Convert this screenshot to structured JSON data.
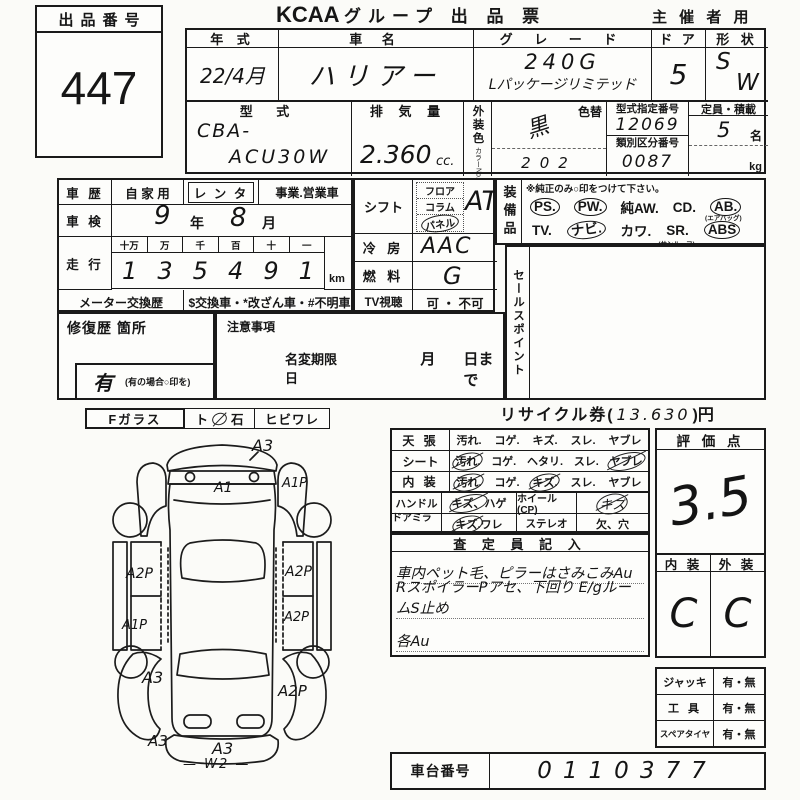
{
  "auction": {
    "label": "出品番号",
    "number": "447"
  },
  "header": {
    "brand": "KCAA",
    "title": "グループ 出 品 票",
    "organizer": "主 催 者 用"
  },
  "vehicle": {
    "year": {
      "label": "年 式",
      "value": "22/4月"
    },
    "name": {
      "label": "車 名",
      "value": "ハリアー"
    },
    "grade": {
      "label": "グ レ ー ド",
      "line1": "240G",
      "line2": "Lパッケージリミテッド"
    },
    "door": {
      "label": "ド ア",
      "value": "5"
    },
    "shape": {
      "label": "形 状",
      "v1": "S",
      "v2": "W"
    },
    "model": {
      "label": "型 式",
      "line1": "CBA-",
      "line2": "ACU30W"
    },
    "displacement": {
      "label": "排 気 量",
      "value": "2.360",
      "unit": "cc."
    },
    "ext_color": {
      "label": "外装色",
      "no_label": "カラーNo.",
      "change_label": "色替",
      "value": "黒",
      "code": "202"
    },
    "type_cert": {
      "label": "型式指定番号",
      "value": "12069"
    },
    "class_no": {
      "label": "類別区分番号",
      "value": "0087"
    },
    "capacity": {
      "label": "定員・積載",
      "value": "5",
      "unit": "名",
      "load_unit": "kg"
    }
  },
  "history": {
    "car_use": {
      "label": "車 歴",
      "opt1": "自 家 用",
      "opt2": "レ ン タ",
      "opt3": "事業.営業車"
    },
    "inspection": {
      "label": "車 検",
      "year": "9",
      "year_unit": "年",
      "month": "8",
      "month_unit": "月"
    },
    "mileage": {
      "label": "走 行",
      "units": [
        "十万",
        "万",
        "千",
        "百",
        "十",
        "一"
      ],
      "digits": [
        "1",
        "3",
        "5",
        "4",
        "9",
        "1"
      ],
      "km": "km"
    },
    "meter": {
      "label": "メーター交換歴",
      "text": "$交換車・*改ざん車・#不明車"
    },
    "repair": {
      "label": "修復歴  箇所",
      "yes": "有",
      "note": "(有の場合○印を)"
    },
    "caution": {
      "label": "注意事項"
    },
    "name_change": {
      "label": "名変期限日",
      "month": "月",
      "day": "日まで"
    }
  },
  "specs": {
    "shift": {
      "label": "シフト",
      "opt1": "フロア",
      "opt2": "コラム",
      "opt3": "パネル",
      "value": "AT."
    },
    "ac": {
      "label": "冷 房",
      "value": "AAC"
    },
    "fuel": {
      "label": "燃 料",
      "value": "G"
    },
    "tv": {
      "label": "TV視聴",
      "value": "可 ・ 不可"
    }
  },
  "equipment": {
    "label": "装備品",
    "note": "※純正のみ○印をつけて下さい。",
    "row1": [
      {
        "t": "PS.",
        "circled": true
      },
      {
        "t": "PW.",
        "circled": true
      },
      {
        "t": "純AW."
      },
      {
        "t": "CD."
      },
      {
        "t": "AB.",
        "circled": true,
        "sub": "(エアバッグ)"
      }
    ],
    "row2": [
      {
        "t": "TV."
      },
      {
        "t": "ナビ.",
        "circled": true
      },
      {
        "t": "カワ."
      },
      {
        "t": "SR.",
        "sub": "(サンルーフ)"
      },
      {
        "t": "ABS",
        "circled": true
      }
    ],
    "row3": [
      "新 車 保 証 書.",
      "2WD.",
      "4WD"
    ],
    "sales_point": "セールスポイント"
  },
  "recycle": {
    "pre": "リサイクル券(",
    "value": "13.630",
    "post": ")円"
  },
  "glass": {
    "label": "Fガラス",
    "opt1": "ト",
    "opt2": "石",
    "opt3": "ヒビワレ"
  },
  "condition": {
    "rows": [
      {
        "label": "天 張",
        "items": [
          {
            "t": "汚れ."
          },
          {
            "t": "コゲ."
          },
          {
            "t": "キズ."
          },
          {
            "t": "スレ."
          },
          {
            "t": "ヤブレ"
          }
        ]
      },
      {
        "label": "シート",
        "items": [
          {
            "t": "汚れ.",
            "marked": true
          },
          {
            "t": "コゲ."
          },
          {
            "t": "ヘタリ."
          },
          {
            "t": "スレ."
          },
          {
            "t": "ヤブレ",
            "marked": true
          }
        ]
      },
      {
        "label": "内 装",
        "items": [
          {
            "t": "汚れ.",
            "marked": true
          },
          {
            "t": "コゲ."
          },
          {
            "t": "キズ.",
            "marked": true
          },
          {
            "t": "スレ."
          },
          {
            "t": "ヤブレ"
          }
        ]
      }
    ],
    "rows2": [
      {
        "label": "ハンドル",
        "c1a": "キズ、",
        "c1a_marked": true,
        "c1b": "ハゲ",
        "c2": "ホイール(CP)",
        "c3": "キズ",
        "c3_marked": true
      },
      {
        "label": "ドアミラー",
        "c1a": "キズ.",
        "c1a_marked": true,
        "c1b": "ワレ",
        "c2": "ステレオ",
        "c3": "欠、穴",
        "c3_marked": false
      }
    ]
  },
  "inspector": {
    "header": "査 定 員 記 入",
    "line1": "車内ペット毛、ピラーはさみこみAu",
    "line2": "RスポイラーPアセ、下回り E/gルームS止め",
    "line3": "各Au"
  },
  "score": {
    "label": "評 価 点",
    "value": "3.5",
    "interior_label": "内 装",
    "exterior_label": "外 装",
    "interior": "C",
    "exterior": "C"
  },
  "accessories": [
    {
      "label": "ジャッキ",
      "value": "有・無"
    },
    {
      "label": "工 具",
      "value": "有・無"
    },
    {
      "label": "スペアタイヤ",
      "value": "有・無"
    }
  ],
  "chassis": {
    "label": "車台番号",
    "value": "0110377"
  },
  "diagram": {
    "labels": [
      "A3",
      "A1",
      "A1P",
      "A2P",
      "A2P",
      "A1P",
      "A2P",
      "A3",
      "A2P",
      "A3",
      "A3",
      "— W2 —"
    ]
  }
}
